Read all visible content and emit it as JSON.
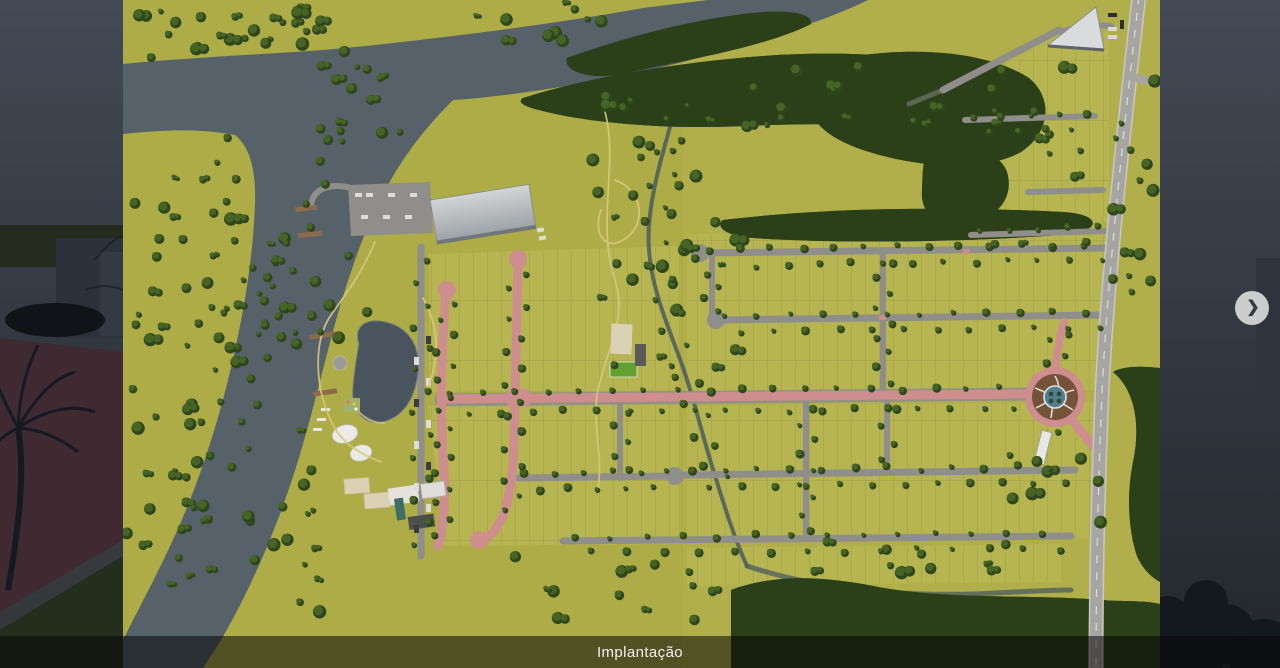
{
  "gallery": {
    "caption": "Implantação",
    "next_icon": "❯"
  },
  "image": {
    "alt": "Implantação — aerial masterplan rendering of a riverside lot development",
    "type": "masterplan-render",
    "features": [
      "river",
      "creek",
      "forest-belts",
      "residential-lot-grid",
      "pink-internal-streets",
      "main-avenue",
      "clubhouse-area",
      "lake",
      "sports-courts",
      "event-hall",
      "marina-piers",
      "entrance-roundabout",
      "fountain",
      "perimeter-road",
      "triangular-building"
    ]
  },
  "colors": {
    "bg_top": "#424a55",
    "bg_bottom": "#23272d",
    "overlay": "rgba(8,8,8,0.55)",
    "caption_text": "#f2f2f2",
    "button_bg": "rgba(238,238,238,0.82)",
    "chevron": "#3a3a3a",
    "grass": "#aeac47",
    "grass_e": "#b6b44f",
    "grass_light": "#b7b552",
    "water": "#566169",
    "creek": "#51605b",
    "tree_dark": "#2e461b",
    "tree_mid": "#476325",
    "forest": "#2b3f19",
    "road_gray": "#8f8e8a",
    "road_light": "#a6a5a1",
    "road_pink": "#ce8e8d",
    "lake": "#49545f",
    "mulch": "#75523a",
    "fountain": "#50808f",
    "roof_light": "#d0d2d4",
    "roof_dark": "#6e7478",
    "court_tan": "#dbd2b6",
    "field_green": "#61a132",
    "path_yellow": "#d6c87e",
    "pier_brown": "#8a6b4b"
  }
}
